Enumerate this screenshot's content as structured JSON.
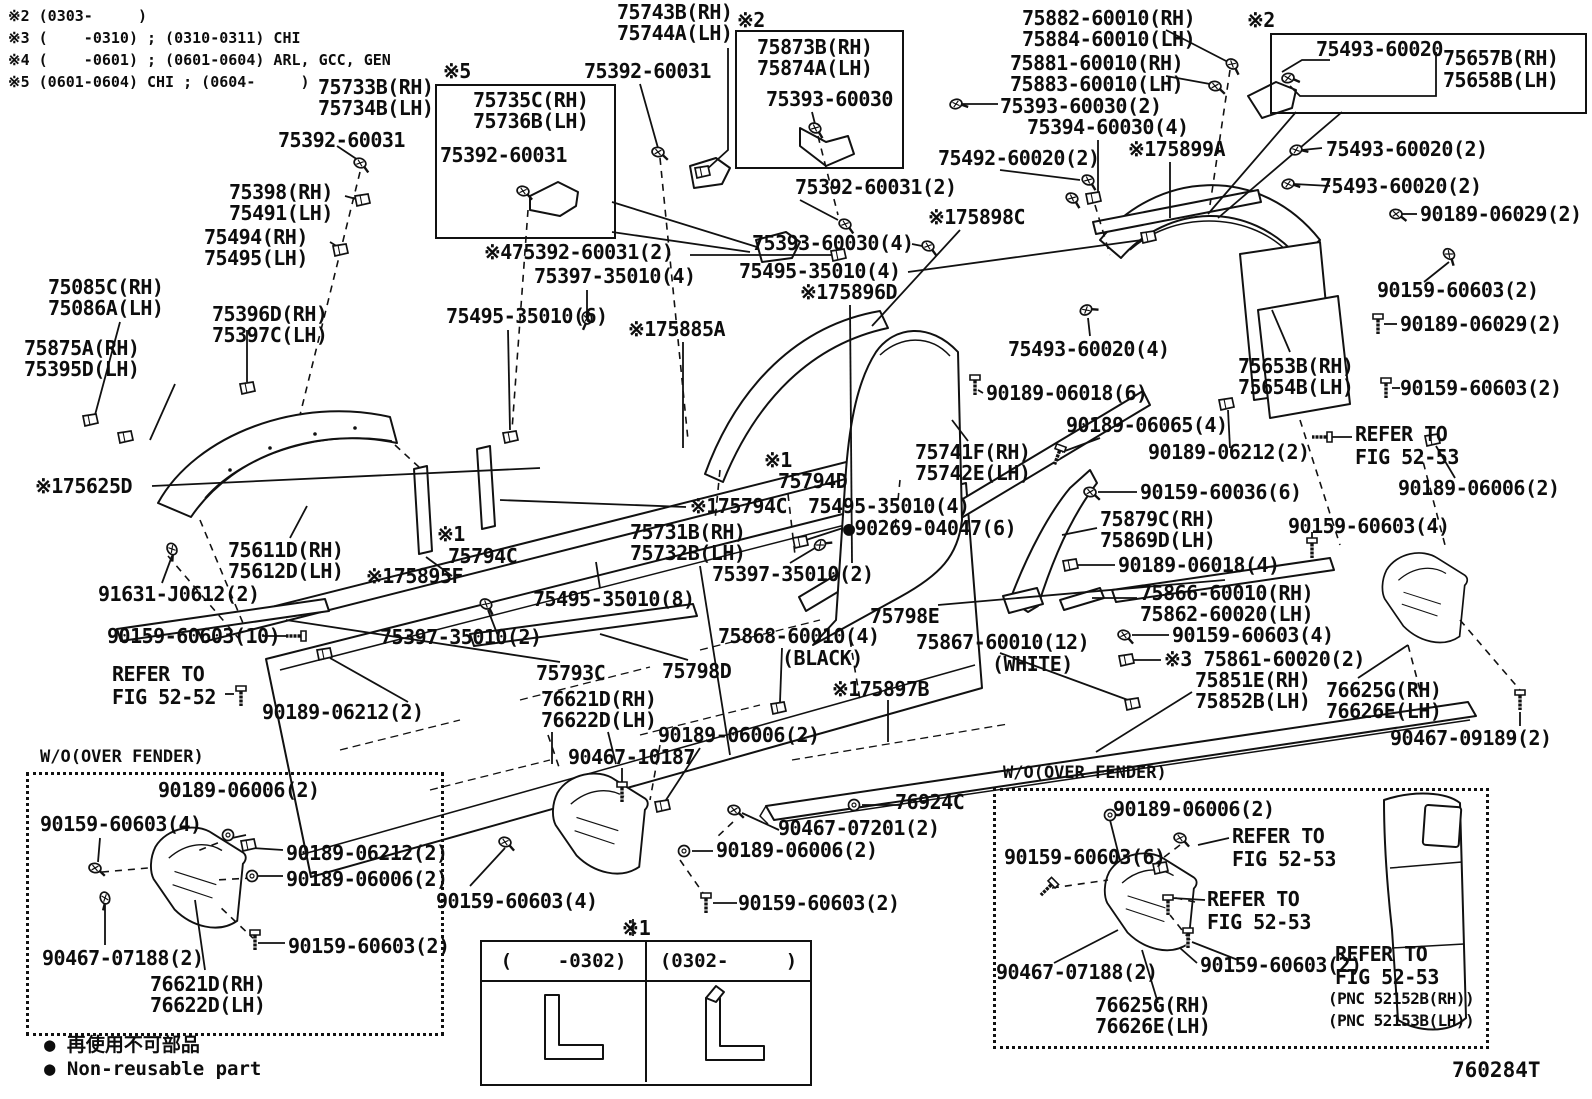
{
  "doc": {
    "figure_code": "760284T",
    "notes": [
      "※2 (0303-     )",
      "※3 (    -0310) ; (0310-0311) CHI",
      "※4 (    -0601) ; (0601-0604) ARL, GCC, GEN",
      "※5 (0601-0604) CHI ; (0604-     )"
    ],
    "legend": [
      "● 再使用不可部品",
      "● Non-reusable part"
    ]
  },
  "insets": {
    "left_box_title": "W/O(OVER FENDER)",
    "right_box_title": "W/O(OVER FENDER)",
    "table_note": "※1",
    "table_columns": [
      "(    -0302)",
      "(0302-     )"
    ]
  },
  "labels": [
    {
      "t": "75743B(RH)",
      "x": 617,
      "y": 2
    },
    {
      "t": "75744A(LH)",
      "x": 617,
      "y": 23
    },
    {
      "t": "75392-60031",
      "x": 584,
      "y": 61
    },
    {
      "t": "※2",
      "x": 737,
      "y": 10
    },
    {
      "t": "75873B(RH)",
      "x": 757,
      "y": 37
    },
    {
      "t": "75874A(LH)",
      "x": 757,
      "y": 58
    },
    {
      "t": "75393-60030",
      "x": 766,
      "y": 89
    },
    {
      "t": "75882-60010(RH)",
      "x": 1022,
      "y": 8
    },
    {
      "t": "75884-60010(LH)",
      "x": 1022,
      "y": 29
    },
    {
      "t": "75881-60010(RH)",
      "x": 1010,
      "y": 53
    },
    {
      "t": "75883-60010(LH)",
      "x": 1010,
      "y": 74
    },
    {
      "t": "75393-60030(2)",
      "x": 1000,
      "y": 96
    },
    {
      "t": "75394-60030(4)",
      "x": 1027,
      "y": 117
    },
    {
      "t": "※2",
      "x": 1247,
      "y": 10
    },
    {
      "t": "75493-60020",
      "x": 1316,
      "y": 39
    },
    {
      "t": "75657B(RH)",
      "x": 1443,
      "y": 48
    },
    {
      "t": "75658B(LH)",
      "x": 1443,
      "y": 70
    },
    {
      "t": "75733B(RH)",
      "x": 318,
      "y": 77
    },
    {
      "t": "75734B(LH)",
      "x": 318,
      "y": 98
    },
    {
      "t": "75392-60031",
      "x": 278,
      "y": 130
    },
    {
      "t": "※5",
      "x": 443,
      "y": 61
    },
    {
      "t": "75735C(RH)",
      "x": 473,
      "y": 90
    },
    {
      "t": "75736B(LH)",
      "x": 473,
      "y": 111
    },
    {
      "t": "75392-60031",
      "x": 440,
      "y": 145
    },
    {
      "t": "75398(RH)",
      "x": 229,
      "y": 182
    },
    {
      "t": "75491(LH)",
      "x": 229,
      "y": 203
    },
    {
      "t": "75494(RH)",
      "x": 204,
      "y": 227
    },
    {
      "t": "75495(LH)",
      "x": 204,
      "y": 248
    },
    {
      "t": "75392-60031(2)",
      "x": 795,
      "y": 177
    },
    {
      "t": "75492-60020(2)",
      "x": 938,
      "y": 148
    },
    {
      "t": "※175899A",
      "x": 1128,
      "y": 139
    },
    {
      "t": "75493-60020(2)",
      "x": 1326,
      "y": 139
    },
    {
      "t": "75493-60020(2)",
      "x": 1320,
      "y": 176
    },
    {
      "t": "90189-06029(2)",
      "x": 1420,
      "y": 204
    },
    {
      "t": "75393-60030(4)",
      "x": 752,
      "y": 233
    },
    {
      "t": "75495-35010(4)",
      "x": 739,
      "y": 261
    },
    {
      "t": "※475392-60031(2)",
      "x": 484,
      "y": 242
    },
    {
      "t": "75397-35010(4)",
      "x": 534,
      "y": 266
    },
    {
      "t": "※175896D",
      "x": 800,
      "y": 282
    },
    {
      "t": "※175898C",
      "x": 928,
      "y": 207
    },
    {
      "t": "90159-60603(2)",
      "x": 1377,
      "y": 280
    },
    {
      "t": "75085C(RH)",
      "x": 48,
      "y": 277
    },
    {
      "t": "75086A(LH)",
      "x": 48,
      "y": 298
    },
    {
      "t": "75396D(RH)",
      "x": 212,
      "y": 304
    },
    {
      "t": "75397C(LH)",
      "x": 212,
      "y": 325
    },
    {
      "t": "75875A(RH)",
      "x": 24,
      "y": 338
    },
    {
      "t": "75395D(LH)",
      "x": 24,
      "y": 359
    },
    {
      "t": "75495-35010(6)",
      "x": 446,
      "y": 306
    },
    {
      "t": "※175885A",
      "x": 628,
      "y": 319
    },
    {
      "t": "90189-06029(2)",
      "x": 1400,
      "y": 314
    },
    {
      "t": "75493-60020(4)",
      "x": 1008,
      "y": 339
    },
    {
      "t": "75653B(RH)",
      "x": 1238,
      "y": 356
    },
    {
      "t": "75654B(LH)",
      "x": 1238,
      "y": 377
    },
    {
      "t": "90189-06018(6)",
      "x": 986,
      "y": 383
    },
    {
      "t": "90159-60603(2)",
      "x": 1400,
      "y": 378
    },
    {
      "t": "90189-06065(4)",
      "x": 1066,
      "y": 415
    },
    {
      "t": "90189-06212(2)",
      "x": 1148,
      "y": 442
    },
    {
      "t": "REFER TO",
      "x": 1355,
      "y": 424
    },
    {
      "t": "FIG 52-53",
      "x": 1355,
      "y": 447
    },
    {
      "t": "75741F(RH)",
      "x": 915,
      "y": 442
    },
    {
      "t": "75742E(LH)",
      "x": 915,
      "y": 463
    },
    {
      "t": "※175625D",
      "x": 35,
      "y": 476
    },
    {
      "t": "※1",
      "x": 764,
      "y": 450
    },
    {
      "t": "75794D",
      "x": 778,
      "y": 471
    },
    {
      "t": "90189-06006(2)",
      "x": 1398,
      "y": 478
    },
    {
      "t": "90159-60036(6)",
      "x": 1140,
      "y": 482
    },
    {
      "t": "※175794C",
      "x": 690,
      "y": 496
    },
    {
      "t": "75495-35010(4)",
      "x": 808,
      "y": 496
    },
    {
      "t": "●90269-04047(6)",
      "x": 843,
      "y": 518
    },
    {
      "t": "75879C(RH)",
      "x": 1100,
      "y": 509
    },
    {
      "t": "75869D(LH)",
      "x": 1100,
      "y": 530
    },
    {
      "t": "90159-60603(4)",
      "x": 1288,
      "y": 516
    },
    {
      "t": "75731B(RH)",
      "x": 630,
      "y": 522
    },
    {
      "t": "75732B(LH)",
      "x": 630,
      "y": 543
    },
    {
      "t": "※1",
      "x": 437,
      "y": 524
    },
    {
      "t": "75794C",
      "x": 448,
      "y": 546
    },
    {
      "t": "75397-35010(2)",
      "x": 712,
      "y": 564
    },
    {
      "t": "90189-06018(4)",
      "x": 1118,
      "y": 555
    },
    {
      "t": "75866-60010(RH)",
      "x": 1140,
      "y": 583
    },
    {
      "t": "75862-60020(LH)",
      "x": 1140,
      "y": 604
    },
    {
      "t": "75798E",
      "x": 870,
      "y": 606
    },
    {
      "t": "75495-35010(8)",
      "x": 533,
      "y": 589
    },
    {
      "t": "※175895F",
      "x": 366,
      "y": 566
    },
    {
      "t": "75611D(RH)",
      "x": 228,
      "y": 540
    },
    {
      "t": "75612D(LH)",
      "x": 228,
      "y": 561
    },
    {
      "t": "91631-J0612(2)",
      "x": 98,
      "y": 584
    },
    {
      "t": "90159-60603(10)",
      "x": 107,
      "y": 626
    },
    {
      "t": "75397-35010(2)",
      "x": 380,
      "y": 627
    },
    {
      "t": "90159-60603(4)",
      "x": 1172,
      "y": 625
    },
    {
      "t": "※3 75861-60020(2)",
      "x": 1164,
      "y": 649
    },
    {
      "t": "75851E(RH)",
      "x": 1195,
      "y": 670
    },
    {
      "t": "75852B(LH)",
      "x": 1195,
      "y": 691
    },
    {
      "t": "REFER TO",
      "x": 112,
      "y": 664
    },
    {
      "t": "FIG 52-52",
      "x": 112,
      "y": 687
    },
    {
      "t": "90189-06212(2)",
      "x": 262,
      "y": 702
    },
    {
      "t": "75793C",
      "x": 536,
      "y": 663
    },
    {
      "t": "75798D",
      "x": 662,
      "y": 661
    },
    {
      "t": "75868-60010(4)",
      "x": 718,
      "y": 626
    },
    {
      "t": "(BLACK)",
      "x": 782,
      "y": 648
    },
    {
      "t": "75867-60010(12)",
      "x": 916,
      "y": 632
    },
    {
      "t": "(WHITE)",
      "x": 992,
      "y": 654
    },
    {
      "t": "76625G(RH)",
      "x": 1326,
      "y": 680
    },
    {
      "t": "76626E(LH)",
      "x": 1326,
      "y": 701
    },
    {
      "t": "※175897B",
      "x": 832,
      "y": 679
    },
    {
      "t": "76621D(RH)",
      "x": 541,
      "y": 689
    },
    {
      "t": "76622D(LH)",
      "x": 541,
      "y": 710
    },
    {
      "t": "90189-06006(2)",
      "x": 658,
      "y": 725
    },
    {
      "t": "90467-10187",
      "x": 568,
      "y": 747
    },
    {
      "t": "90467-09189(2)",
      "x": 1390,
      "y": 728
    },
    {
      "t": "90159-60603(4)",
      "x": 436,
      "y": 891
    },
    {
      "t": "90467-07201(2)",
      "x": 778,
      "y": 818
    },
    {
      "t": "90189-06006(2)",
      "x": 716,
      "y": 840
    },
    {
      "t": "76924C",
      "x": 895,
      "y": 792
    },
    {
      "t": "90159-60603(2)",
      "x": 738,
      "y": 893
    },
    {
      "t": "90189-06006(2)",
      "x": 158,
      "y": 780
    },
    {
      "t": "90159-60603(4)",
      "x": 40,
      "y": 814
    },
    {
      "t": "90189-06212(2)",
      "x": 286,
      "y": 843
    },
    {
      "t": "90189-06006(2)",
      "x": 286,
      "y": 869
    },
    {
      "t": "90159-60603(2)",
      "x": 288,
      "y": 936
    },
    {
      "t": "90467-07188(2)",
      "x": 42,
      "y": 948
    },
    {
      "t": "76621D(RH)",
      "x": 150,
      "y": 974
    },
    {
      "t": "76622D(LH)",
      "x": 150,
      "y": 995
    },
    {
      "t": "90189-06006(2)",
      "x": 1113,
      "y": 799
    },
    {
      "t": "90159-60603(6)",
      "x": 1004,
      "y": 847
    },
    {
      "t": "REFER TO",
      "x": 1232,
      "y": 826
    },
    {
      "t": "FIG 52-53",
      "x": 1232,
      "y": 849
    },
    {
      "t": "REFER TO",
      "x": 1207,
      "y": 889
    },
    {
      "t": "FIG 52-53",
      "x": 1207,
      "y": 912
    },
    {
      "t": "90467-07188(2)",
      "x": 996,
      "y": 962
    },
    {
      "t": "90159-60603(2)",
      "x": 1200,
      "y": 955
    },
    {
      "t": "76625G(RH)",
      "x": 1095,
      "y": 995
    },
    {
      "t": "76626E(LH)",
      "x": 1095,
      "y": 1016
    },
    {
      "t": "REFER TO",
      "x": 1335,
      "y": 944
    },
    {
      "t": "FIG 52-53",
      "x": 1335,
      "y": 967
    },
    {
      "t": "(PNC 52152B(RH))",
      "x": 1328,
      "y": 991,
      "fs": 16
    },
    {
      "t": "(PNC 52153B(LH))",
      "x": 1328,
      "y": 1013,
      "fs": 16
    }
  ]
}
